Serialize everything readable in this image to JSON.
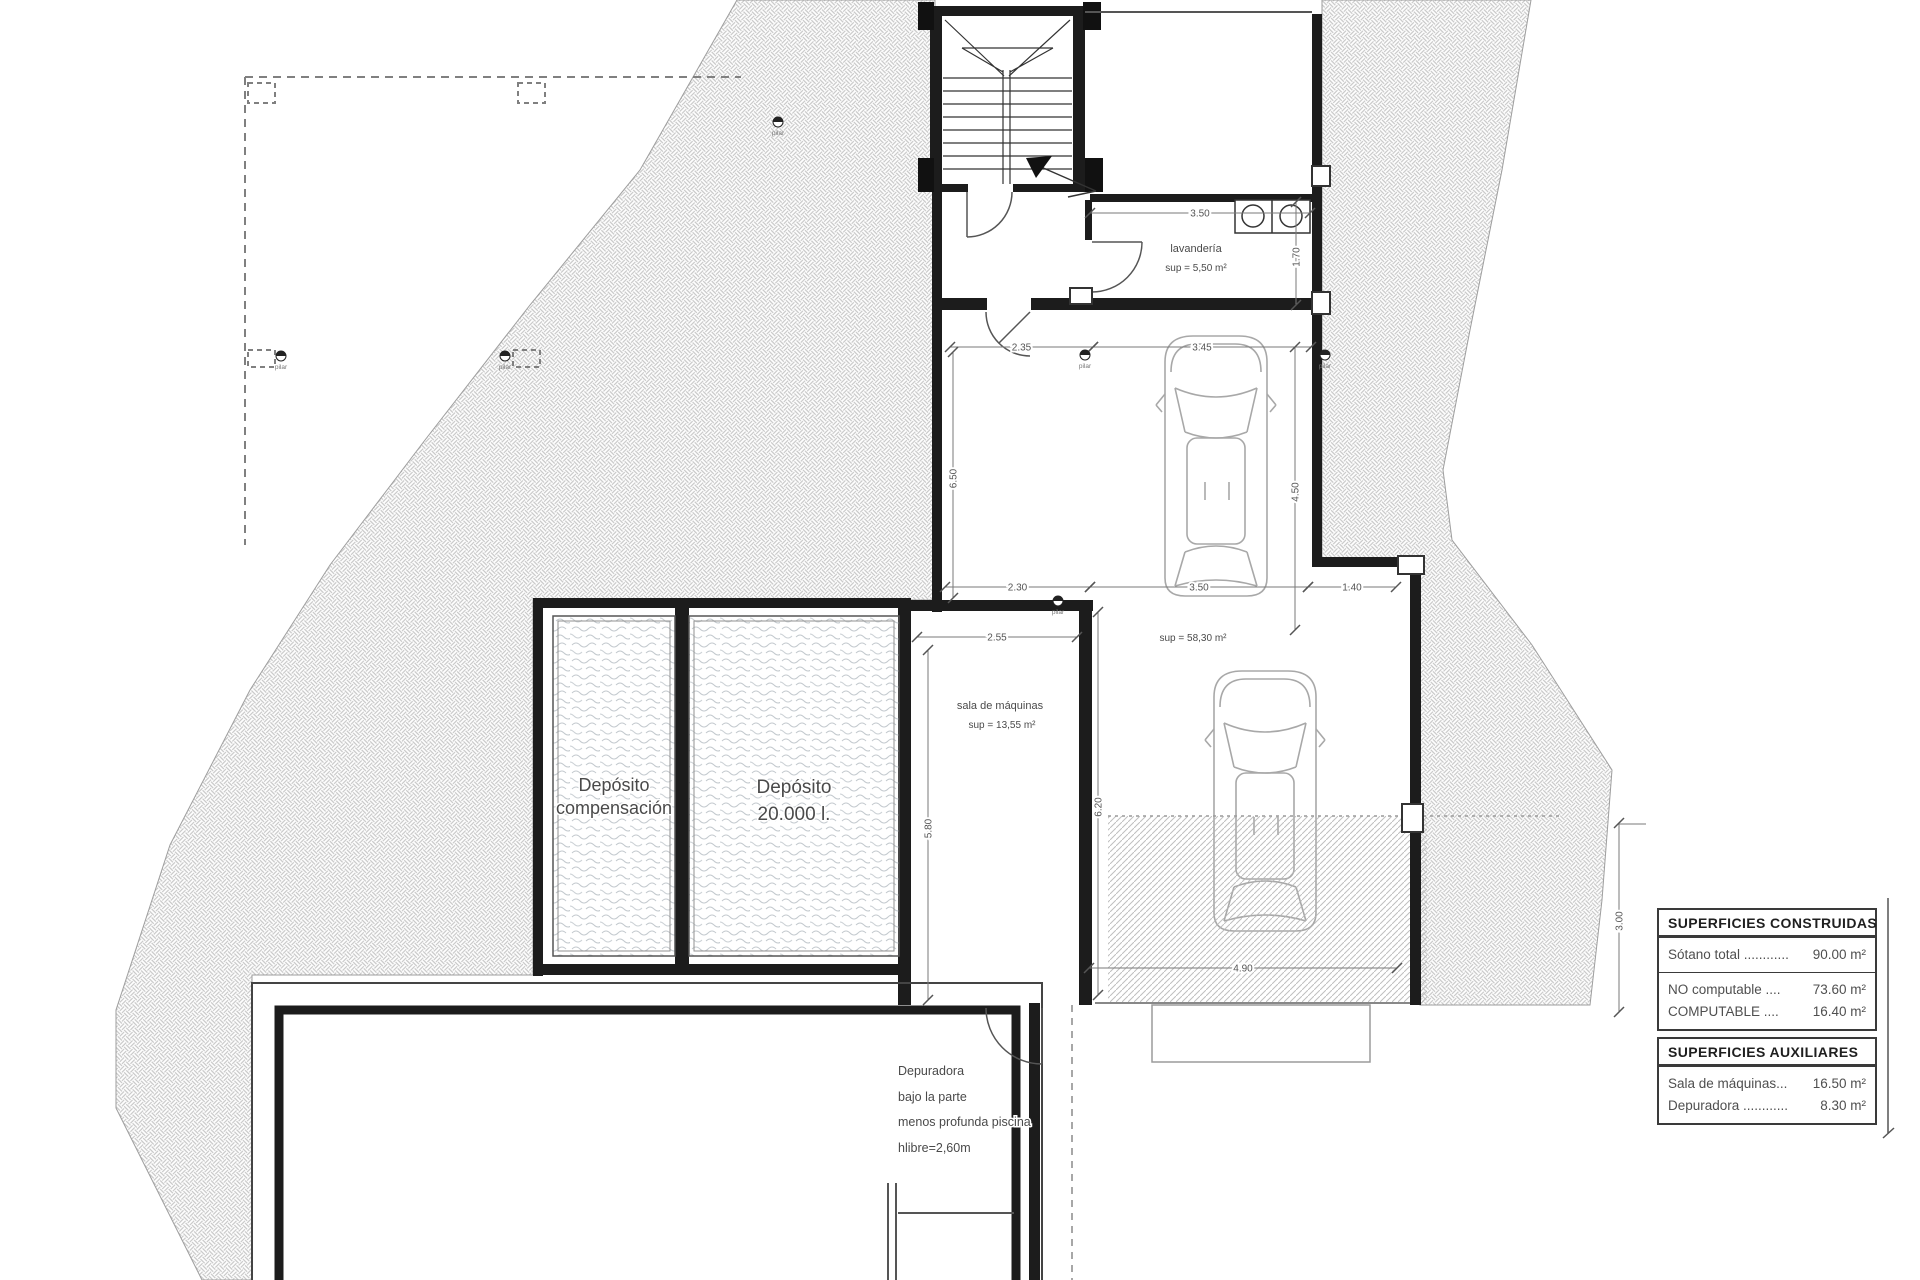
{
  "plan": {
    "rooms": {
      "lavanderia": {
        "name": "lavandería",
        "area": "sup = 5,50 m²"
      },
      "sala_maquinas": {
        "name": "sala de máquinas",
        "area": "sup = 13,55 m²"
      },
      "garaje": {
        "area": "sup = 58,30 m²"
      },
      "deposito_compensacion": {
        "line1": "Depósito",
        "line2": "compensación"
      },
      "deposito_20000": {
        "line1": "Depósito",
        "line2": "20.000 l."
      }
    },
    "labels": [
      {
        "t": "lavandería",
        "x": 1196,
        "y": 252,
        "s": 11
      },
      {
        "t": "sup = 5,50 m²",
        "x": 1196,
        "y": 271,
        "s": 10
      },
      {
        "t": "sala de máquinas",
        "x": 1000,
        "y": 709,
        "s": 11
      },
      {
        "t": "sup = 13,55 m²",
        "x": 1002,
        "y": 728,
        "s": 10
      },
      {
        "t": "sup = 58,30 m²",
        "x": 1193,
        "y": 641,
        "s": 10
      },
      {
        "t": "Depósito",
        "x": 614,
        "y": 791,
        "s": 18
      },
      {
        "t": "compensación",
        "x": 614,
        "y": 814,
        "s": 18
      },
      {
        "t": "Depósito",
        "x": 794,
        "y": 793,
        "s": 19
      },
      {
        "t": "20.000 l.",
        "x": 794,
        "y": 820,
        "s": 19
      }
    ],
    "note_lines": [
      {
        "t": "Depuradora",
        "x": 898,
        "y": 1075
      },
      {
        "t": "bajo la parte",
        "x": 898,
        "y": 1101
      },
      {
        "t": "menos profunda piscina",
        "x": 898,
        "y": 1126
      },
      {
        "t": "hlibre=2,60m",
        "x": 898,
        "y": 1152
      }
    ],
    "dimensions": [
      {
        "value": "3.50",
        "orient": "h",
        "x1": 1090,
        "x2": 1310,
        "y": 213
      },
      {
        "value": "1.70",
        "orient": "v",
        "y1": 202,
        "y2": 305,
        "x": 1296
      },
      {
        "value": "2.35",
        "orient": "h",
        "x1": 950,
        "x2": 1093,
        "y": 347
      },
      {
        "value": "3.45",
        "orient": "h",
        "x1": 1093,
        "x2": 1311,
        "y": 347
      },
      {
        "value": "6.50",
        "orient": "v",
        "y1": 352,
        "y2": 598,
        "x": 953
      },
      {
        "value": "4.50",
        "orient": "v",
        "y1": 347,
        "y2": 630,
        "x": 1295
      },
      {
        "value": "2.30",
        "orient": "h",
        "x1": 945,
        "x2": 1090,
        "y": 587
      },
      {
        "value": "3.50",
        "orient": "h",
        "x1": 1090,
        "x2": 1308,
        "y": 587
      },
      {
        "value": "1.40",
        "orient": "h",
        "x1": 1308,
        "x2": 1396,
        "y": 587
      },
      {
        "value": "2.55",
        "orient": "h",
        "x1": 917,
        "x2": 1077,
        "y": 637
      },
      {
        "value": "5.80",
        "orient": "v",
        "y1": 650,
        "y2": 1000,
        "x": 928
      },
      {
        "value": "6.20",
        "orient": "v",
        "y1": 612,
        "y2": 995,
        "x": 1098
      },
      {
        "value": "4.90",
        "orient": "h",
        "x1": 1089,
        "x2": 1397,
        "y": 968
      },
      {
        "value": "3.00",
        "orient": "v",
        "y1": 823,
        "y2": 1012,
        "x": 1619
      }
    ],
    "pilar_label": "pilar",
    "pilar_markers": [
      {
        "x": 281,
        "y": 356
      },
      {
        "x": 505,
        "y": 356
      },
      {
        "x": 778,
        "y": 122
      },
      {
        "x": 1085,
        "y": 355
      },
      {
        "x": 1325,
        "y": 355
      },
      {
        "x": 1058,
        "y": 601
      }
    ]
  },
  "legend": {
    "tables": [
      {
        "title": "SUPERFICIES CONSTRUIDAS",
        "groups": [
          [
            {
              "label": "Sótano total ............",
              "value": "90.00 m²"
            }
          ],
          [
            {
              "label": "NO computable ....",
              "value": "73.60 m²"
            },
            {
              "label": "COMPUTABLE      ....",
              "value": "16.40 m²"
            }
          ]
        ]
      },
      {
        "title": "SUPERFICIES AUXILIARES",
        "groups": [
          [
            {
              "label": "Sala de máquinas...",
              "value": "16.50 m²"
            },
            {
              "label": "Depuradora ............",
              "value": "8.30 m²"
            }
          ]
        ]
      }
    ]
  }
}
